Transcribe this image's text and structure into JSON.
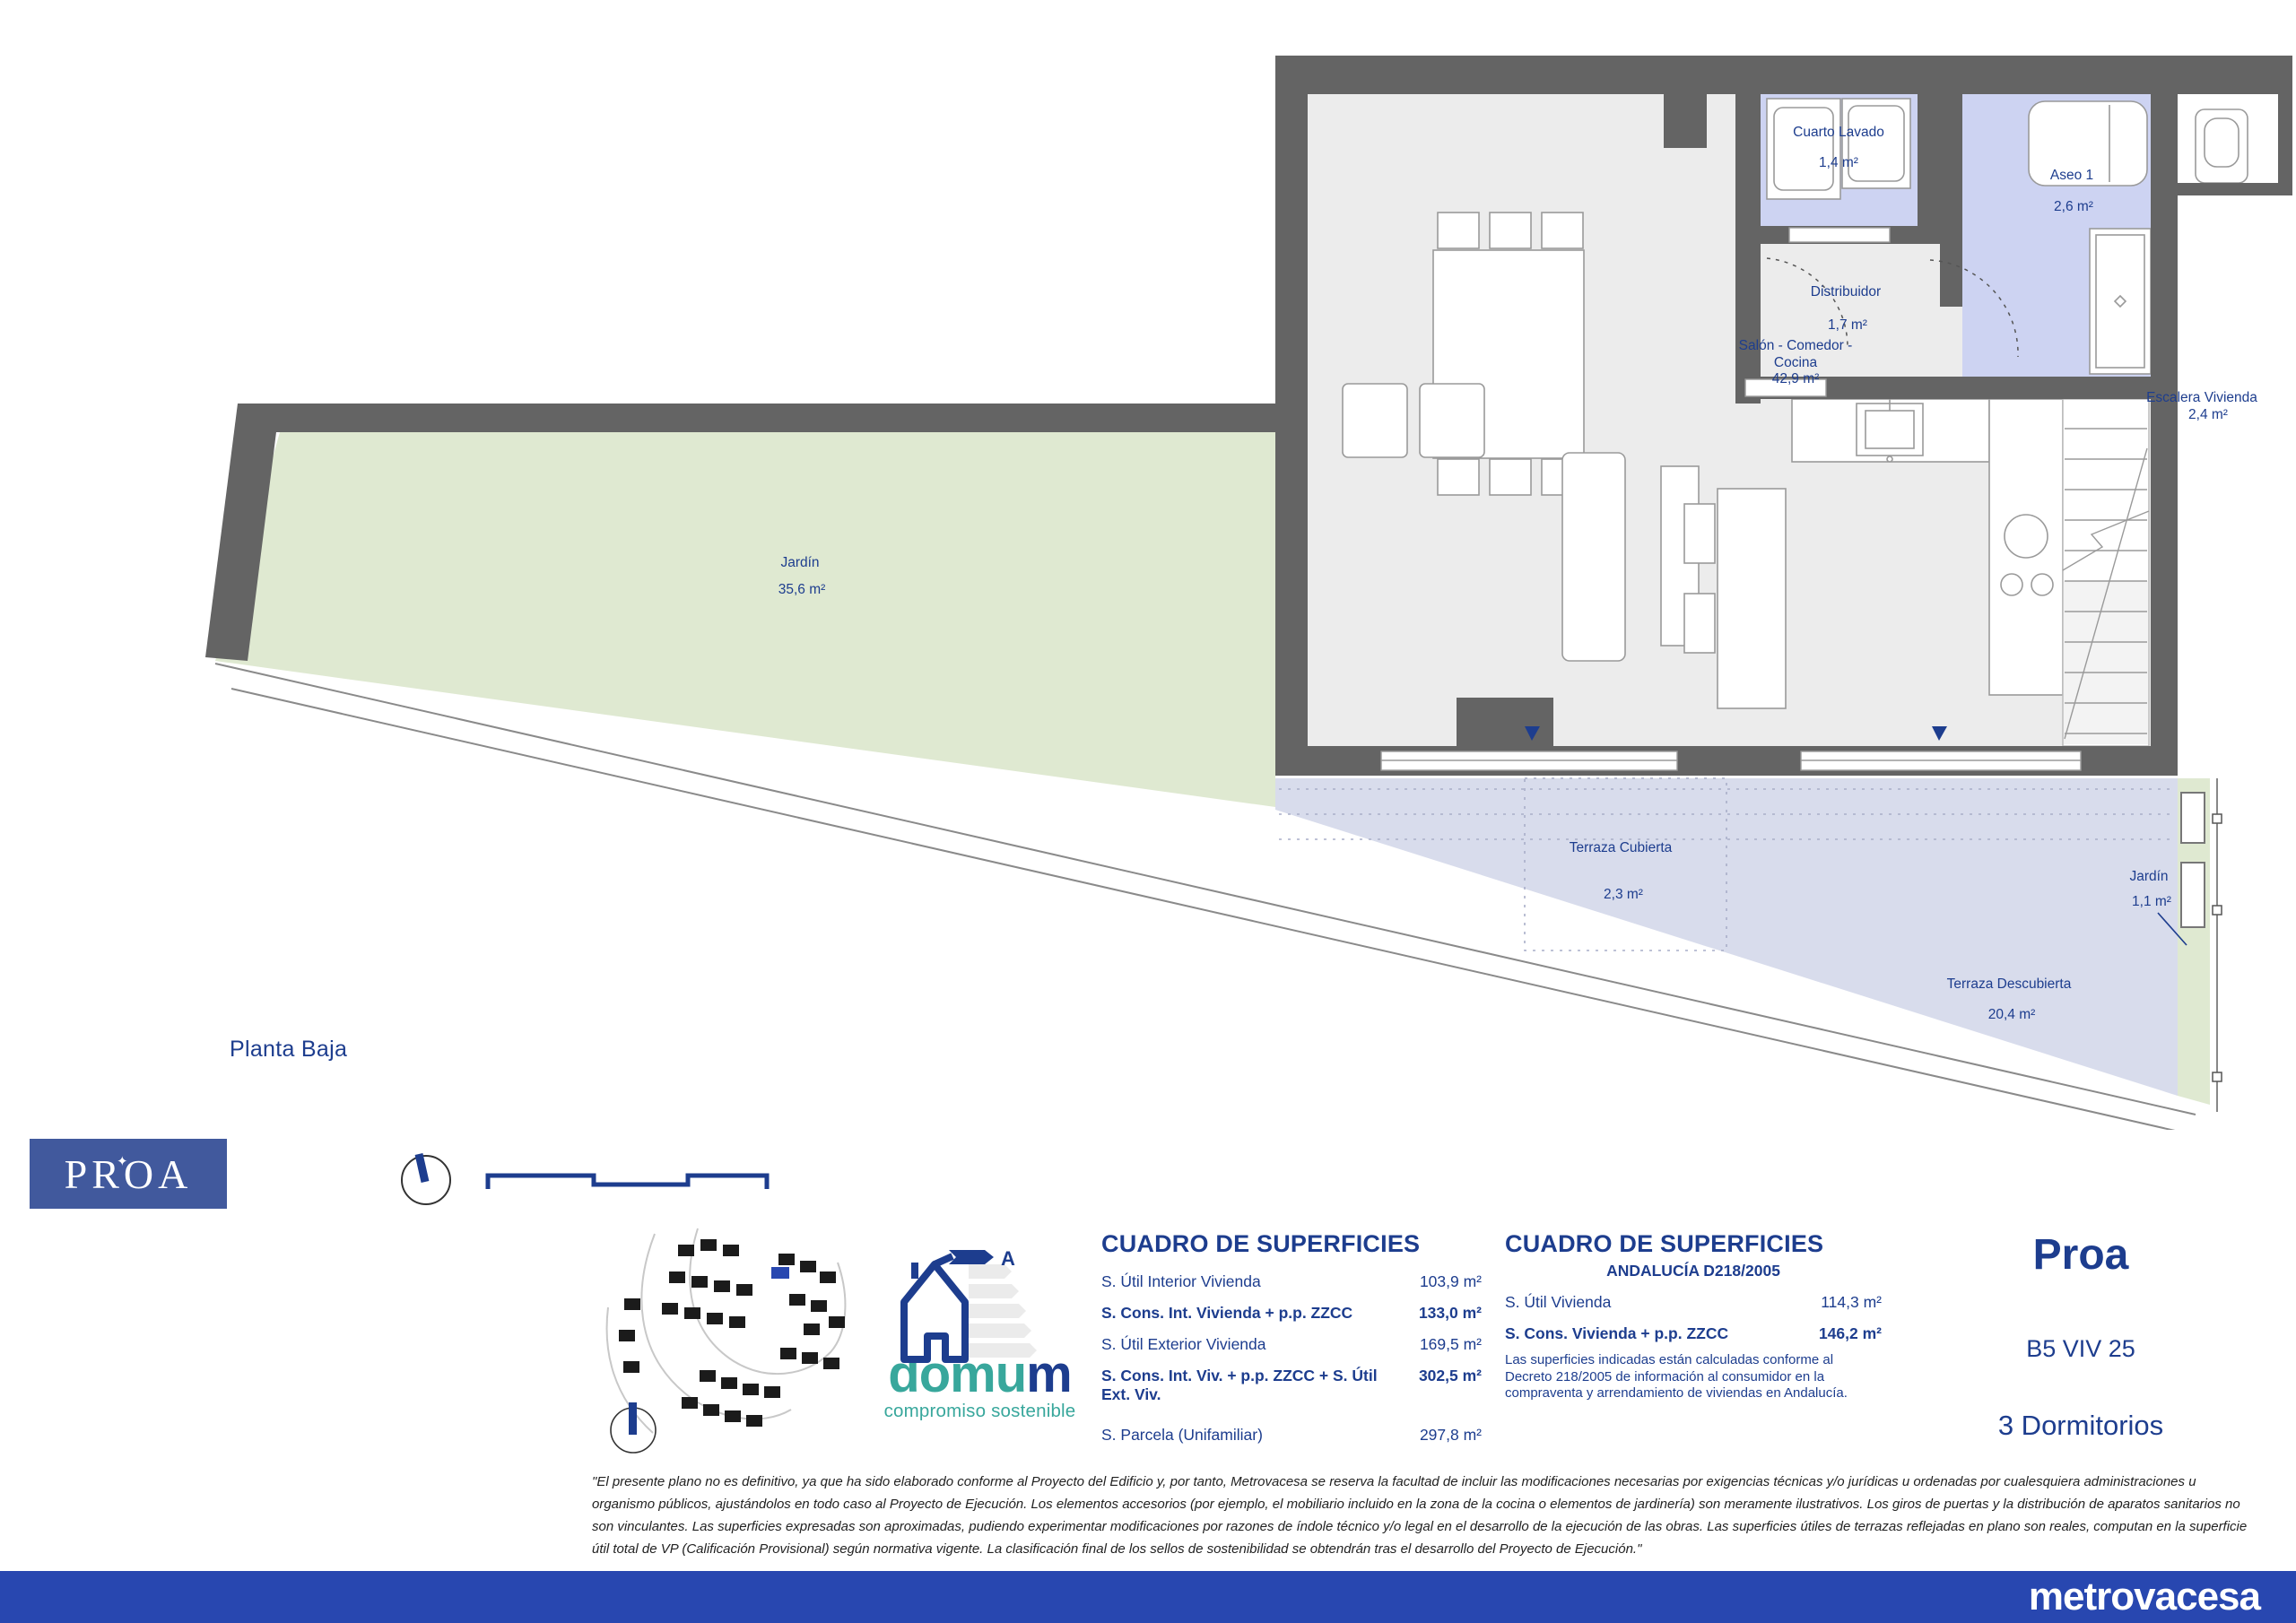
{
  "plan": {
    "floor_label": "Planta Baja",
    "rooms": {
      "lavado": {
        "name": "Cuarto Lavado",
        "area": "1,4 m²"
      },
      "aseo": {
        "name": "Aseo 1",
        "area": "2,6 m²"
      },
      "distribuidor": {
        "name": "Distribuidor",
        "area": "1,7 m²"
      },
      "jardin": {
        "name": "Jardín",
        "area": "35,6 m²"
      },
      "salon": {
        "line1": "Salón - Comedor -",
        "line2": "Cocina",
        "area": "42,9 m²"
      },
      "escalera": {
        "name": "Escalera Vivienda",
        "area": "2,4 m²"
      },
      "terraza_cubierta": {
        "name": "Terraza Cubierta",
        "area": "2,3 m²"
      },
      "terraza_descubierta": {
        "name": "Terraza Descubierta",
        "area": "20,4 m²"
      },
      "jardin_lateral": {
        "name": "Jardín",
        "area": "1,1 m²"
      }
    }
  },
  "branding": {
    "proa_logo": "PROA",
    "project_name": "Proa",
    "unit_code": "B5 VIV 25",
    "bedrooms": "3 Dormitorios",
    "footer_logo": "metrovacesa",
    "domum": {
      "brand_teal": "domu",
      "brand_navy": "m",
      "tagline": "compromiso sostenible",
      "energy_letter": "A"
    }
  },
  "tables": {
    "left": {
      "title": "CUADRO DE SUPERFICIES",
      "rows": [
        {
          "label": "S. Útil Interior Vivienda",
          "value": "103,9 m²"
        },
        {
          "label": "S. Cons. Int. Vivienda + p.p. ZZCC",
          "value": "133,0 m²"
        },
        {
          "label": "S. Útil Exterior Vivienda",
          "value": "169,5 m²"
        },
        {
          "label": "S. Cons. Int. Viv. + p.p. ZZCC + S. Útil Ext. Viv.",
          "value": "302,5 m²"
        },
        {
          "label": "S. Parcela (Unifamiliar)",
          "value": "297,8 m²"
        }
      ]
    },
    "right": {
      "title": "CUADRO DE SUPERFICIES",
      "subtitle": "ANDALUCÍA D218/2005",
      "rows": [
        {
          "label": "S. Útil Vivienda",
          "value": "114,3 m²"
        },
        {
          "label": "S. Cons. Vivienda + p.p. ZZCC",
          "value": "146,2 m²"
        }
      ],
      "note": "Las superficies indicadas están calculadas conforme al Decreto 218/2005 de información al consumidor en la compraventa y arrendamiento de viviendas en Andalucía."
    }
  },
  "disclaimer": "\"El presente plano no es definitivo, ya que ha sido elaborado conforme al Proyecto del Edificio y, por tanto, Metrovacesa se reserva la facultad de incluir las modificaciones necesarias por exigencias técnicas y/o jurídicas u ordenadas por cualesquiera administraciones u organismo públicos, ajustándolos en todo caso al Proyecto de Ejecución. Los elementos accesorios (por ejemplo, el mobiliario incluido en la zona de la cocina o elementos de jardinería) son meramente ilustrativos. Los giros de puertas y la distribución de aparatos sanitarios no son vinculantes. Las superficies expresadas son aproximadas, pudiendo experimentar modificaciones por razones de índole técnico y/o legal en el desarrollo de la ejecución de las obras. Las superficies útiles de terrazas reflejadas en plano son reales, computan en la superficie útil total de VP (Calificación Provisional) según normativa vigente. La clasificación final de los sellos de sostenibilidad se obtendrán tras el desarrollo del Proyecto de Ejecución.\"",
  "colors": {
    "navy": "#1d3d8e",
    "wall_gray": "#646464",
    "lavender": "#cdd3f2",
    "garden_green": "#dfe9d1",
    "terrace_blue": "#d8dcec",
    "footer_blue": "#2847b0",
    "teal": "#38a79c",
    "proa_box_blue": "#41599d"
  }
}
